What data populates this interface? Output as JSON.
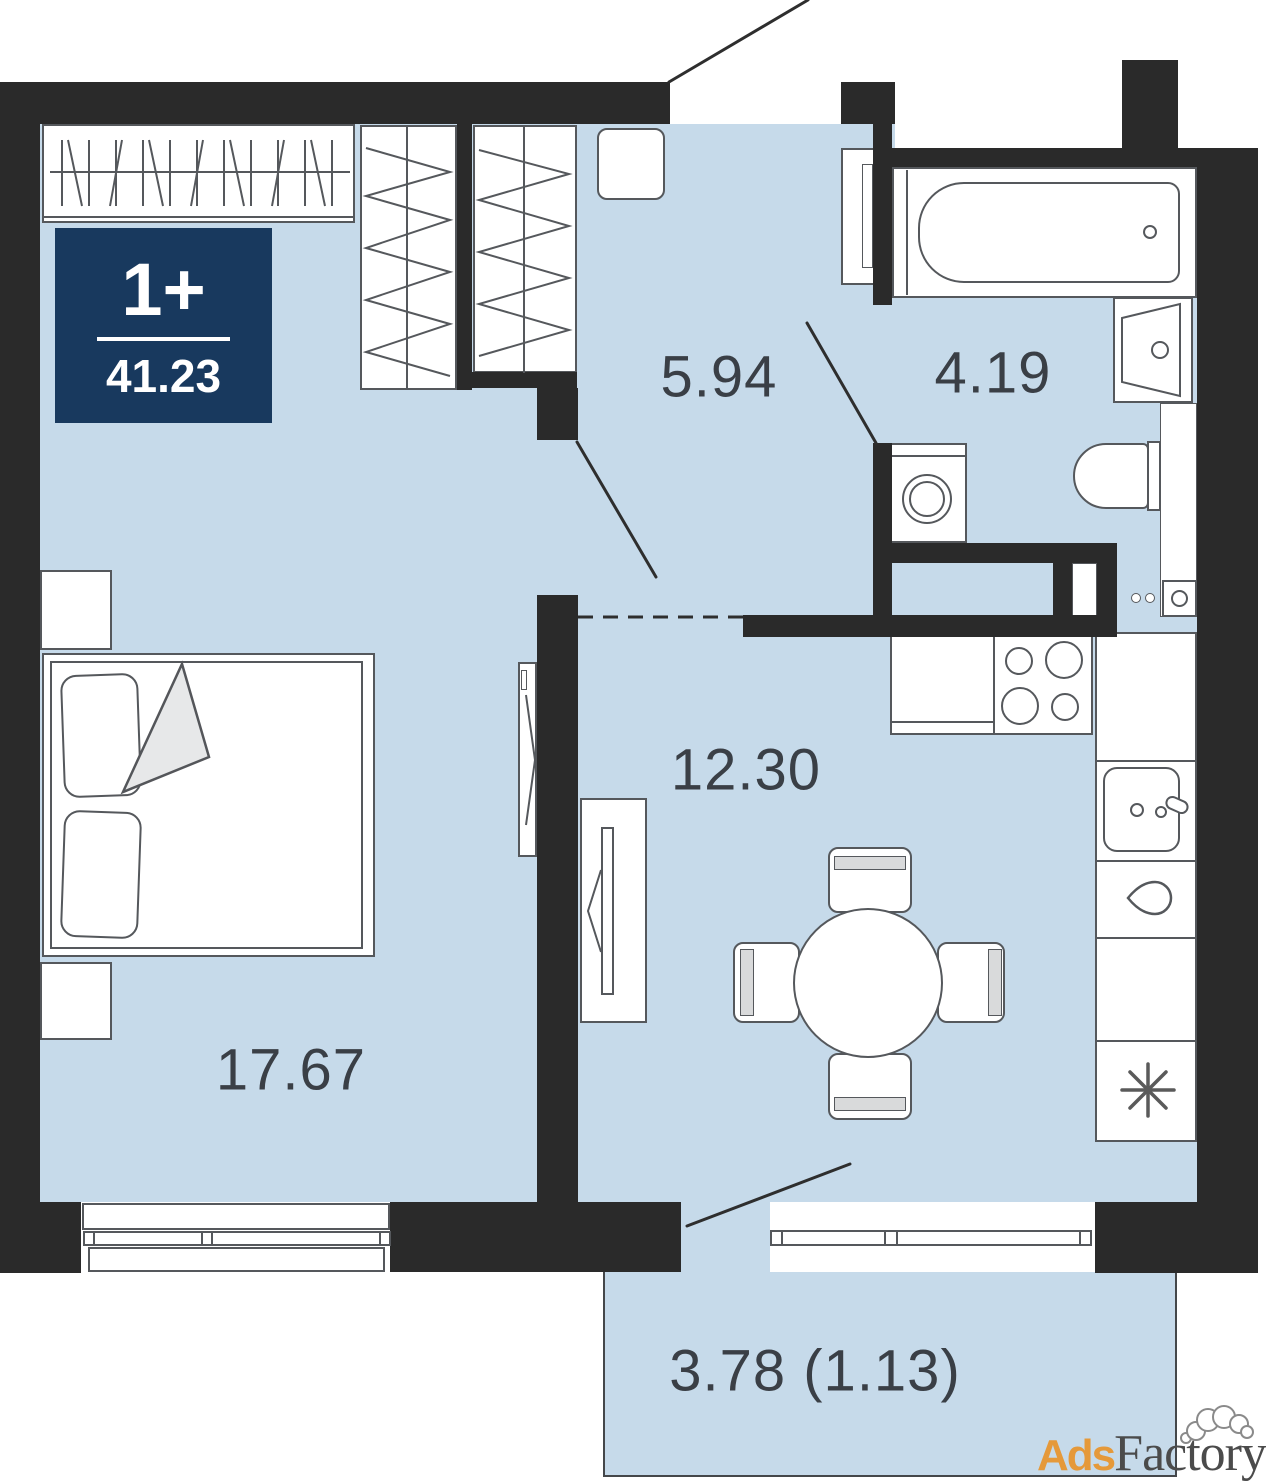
{
  "badge": {
    "unit_type": "1+",
    "total_area": "41.23"
  },
  "rooms": {
    "hallway": "5.94",
    "bathroom": "4.19",
    "living_kitchen": "12.30",
    "bedroom": "17.67",
    "balcony": "3.78 (1.13)"
  },
  "watermark": {
    "prefix": "Ads",
    "suffix": "Factory"
  },
  "colors": {
    "floor": "#c6daea",
    "wall": "#2a2a2a",
    "badge_bg": "#18395e",
    "label_text": "#3a3f46",
    "outline_gray": "#55585c",
    "watermark_orange": "#e5993a"
  }
}
